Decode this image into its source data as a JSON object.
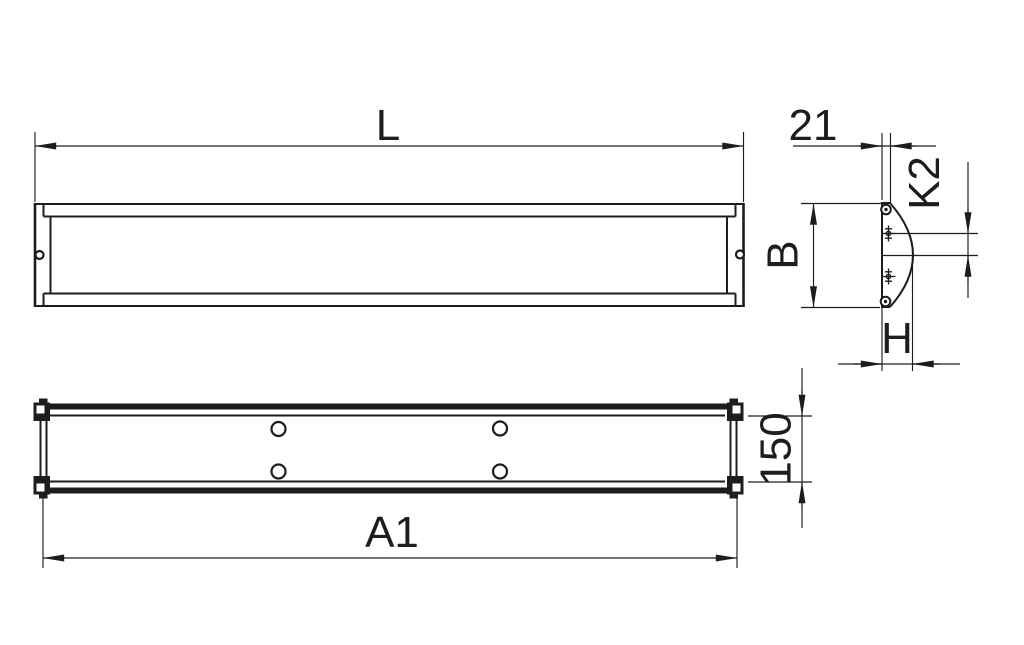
{
  "drawing": {
    "background_color": "#ffffff",
    "line_color": "#1d1d1d",
    "dimensions": {
      "overall_length": "L",
      "back_plate_depth": "21",
      "suspension_offset": "K2",
      "profile_width": "B",
      "profile_height": "H",
      "body_width": "150",
      "mounting_length": "A1"
    },
    "symbols": {
      "screw_head": "circle-with-center-dot",
      "position_mark": "crosshair-with-ticks"
    }
  }
}
